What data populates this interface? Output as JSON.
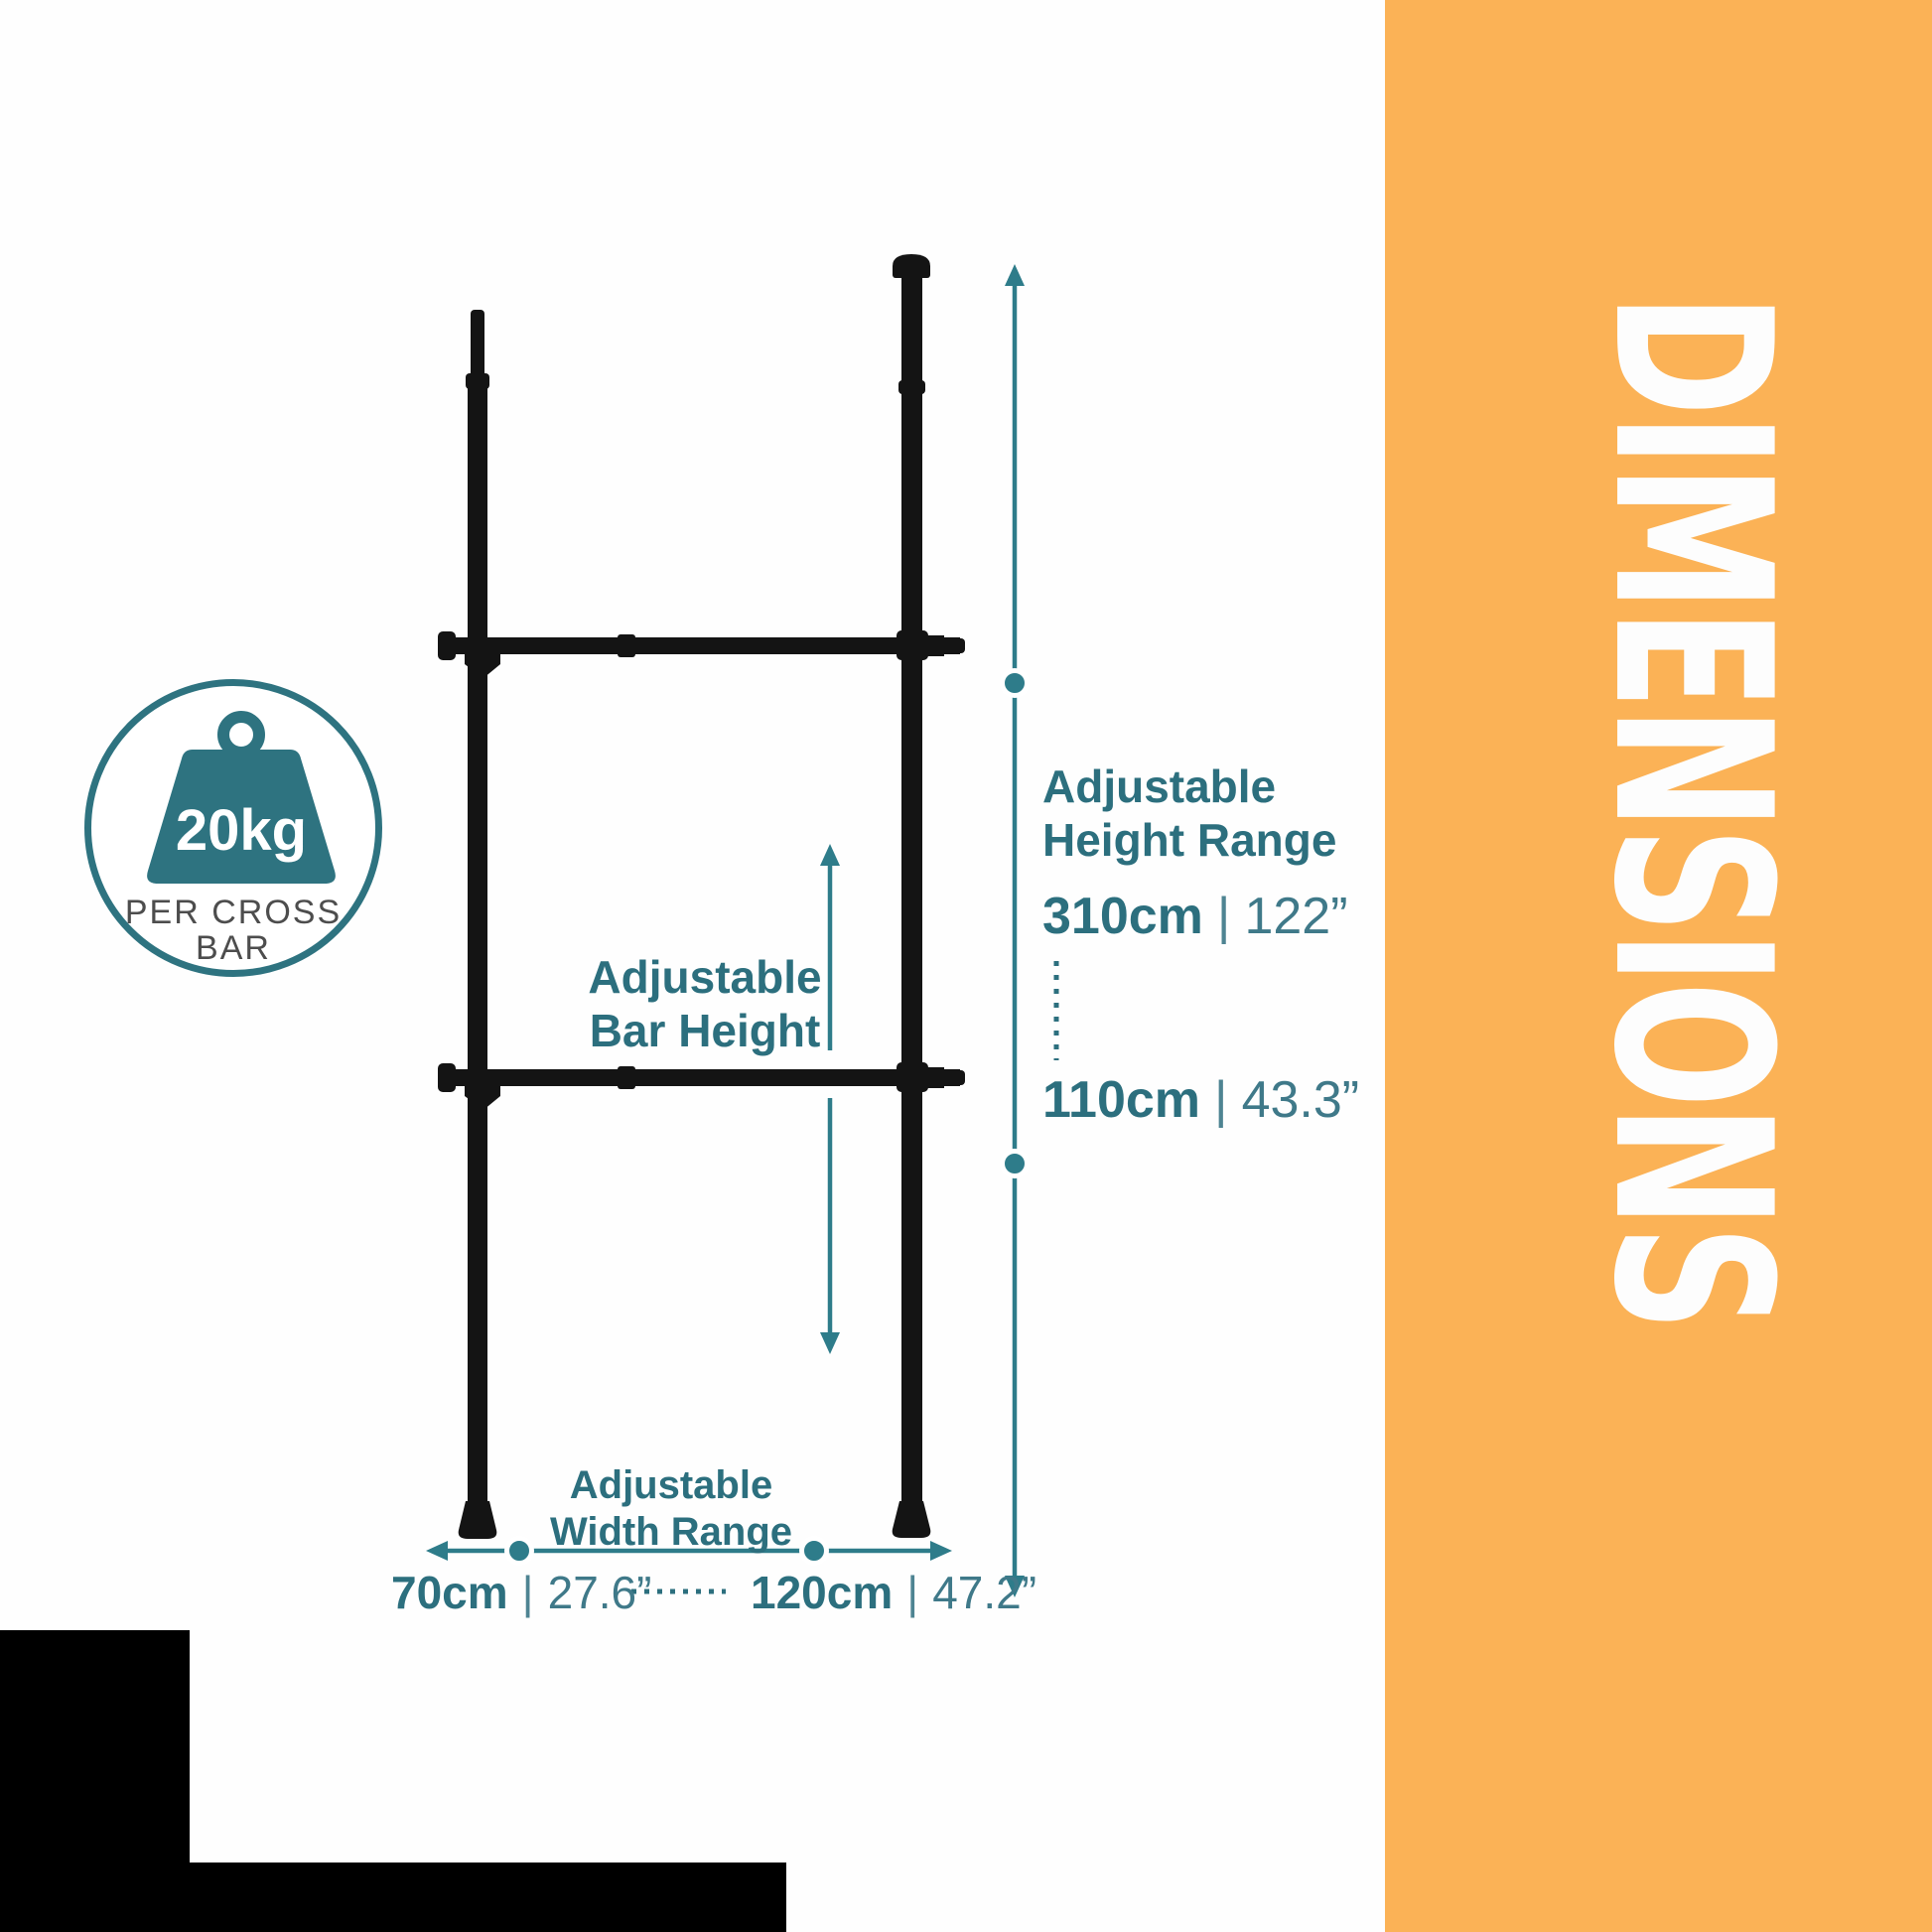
{
  "colors": {
    "orange_panel": "#FBB256",
    "teal_text": "#2C6F7E",
    "teal_graphic": "#2E7C8A",
    "caption_gray": "#4D4D4D",
    "pole_black": "#141414",
    "white": "#FFFFFF"
  },
  "side_panel": {
    "title": "DIMENSIONS"
  },
  "badge": {
    "weight": "20kg",
    "caption_line1": "PER CROSS",
    "caption_line2": "BAR"
  },
  "bar_height_label": {
    "line1": "Adjustable",
    "line2": "Bar Height"
  },
  "height_range": {
    "line1": "Adjustable",
    "line2": "Height Range",
    "separator": "|",
    "max_cm": "310cm",
    "max_in": "122”",
    "min_cm": "110cm",
    "min_in": "43.3”"
  },
  "width_range": {
    "line1": "Adjustable",
    "line2": "Width Range",
    "separator": "|",
    "min_cm": "70cm",
    "min_in": "27.6”",
    "max_cm": "120cm",
    "max_in": "47.2”"
  }
}
